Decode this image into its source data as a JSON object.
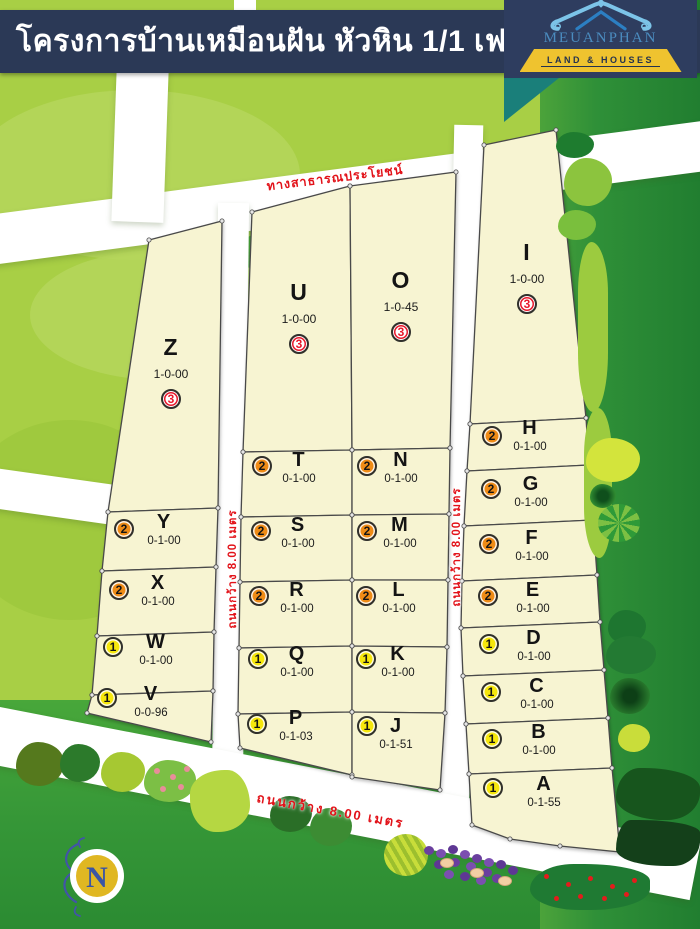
{
  "header": {
    "title": "โครงการบ้านเหมือนฝัน หัวหิน 1/1 เฟส 2"
  },
  "logo": {
    "name": "MEUANPHAN",
    "tagline": "LAND & HOUSES"
  },
  "roads": {
    "public_road_label": "ทางสาธารณประโยชน์",
    "width_label": "ถนนกว้าง 8.00 เมตร"
  },
  "compass": {
    "label": "N"
  },
  "colors": {
    "header_navy": "#2b3956",
    "plot_fill": "#f7f4d2",
    "road_text_red": "#e21219",
    "tier1_yellow": "#f6e70c",
    "tier2_orange": "#ef8b16",
    "tier3_red": "#e8192c"
  },
  "plots": [
    {
      "id": "Z",
      "label": "Z",
      "size": "1-0-00",
      "tier": 3
    },
    {
      "id": "Y",
      "label": "Y",
      "size": "0-1-00",
      "tier": 2
    },
    {
      "id": "X",
      "label": "X",
      "size": "0-1-00",
      "tier": 2
    },
    {
      "id": "W",
      "label": "W",
      "size": "0-1-00",
      "tier": 1
    },
    {
      "id": "V",
      "label": "V",
      "size": "0-0-96",
      "tier": 1
    },
    {
      "id": "U",
      "label": "U",
      "size": "1-0-00",
      "tier": 3
    },
    {
      "id": "T",
      "label": "T",
      "size": "0-1-00",
      "tier": 2
    },
    {
      "id": "S",
      "label": "S",
      "size": "0-1-00",
      "tier": 2
    },
    {
      "id": "R",
      "label": "R",
      "size": "0-1-00",
      "tier": 2
    },
    {
      "id": "Q",
      "label": "Q",
      "size": "0-1-00",
      "tier": 1
    },
    {
      "id": "P",
      "label": "P",
      "size": "0-1-03",
      "tier": 1
    },
    {
      "id": "O",
      "label": "O",
      "size": "1-0-45",
      "tier": 3
    },
    {
      "id": "N",
      "label": "N",
      "size": "0-1-00",
      "tier": 2
    },
    {
      "id": "M",
      "label": "M",
      "size": "0-1-00",
      "tier": 2
    },
    {
      "id": "L",
      "label": "L",
      "size": "0-1-00",
      "tier": 2
    },
    {
      "id": "K",
      "label": "K",
      "size": "0-1-00",
      "tier": 1
    },
    {
      "id": "J",
      "label": "J",
      "size": "0-1-51",
      "tier": 1
    },
    {
      "id": "I",
      "label": "I",
      "size": "1-0-00",
      "tier": 3
    },
    {
      "id": "H",
      "label": "H",
      "size": "0-1-00",
      "tier": 2
    },
    {
      "id": "G",
      "label": "G",
      "size": "0-1-00",
      "tier": 2
    },
    {
      "id": "F",
      "label": "F",
      "size": "0-1-00",
      "tier": 2
    },
    {
      "id": "E",
      "label": "E",
      "size": "0-1-00",
      "tier": 2
    },
    {
      "id": "D",
      "label": "D",
      "size": "0-1-00",
      "tier": 1
    },
    {
      "id": "C",
      "label": "C",
      "size": "0-1-00",
      "tier": 1
    },
    {
      "id": "B",
      "label": "B",
      "size": "0-1-00",
      "tier": 1
    },
    {
      "id": "A",
      "label": "A",
      "size": "0-1-55",
      "tier": 1
    }
  ]
}
